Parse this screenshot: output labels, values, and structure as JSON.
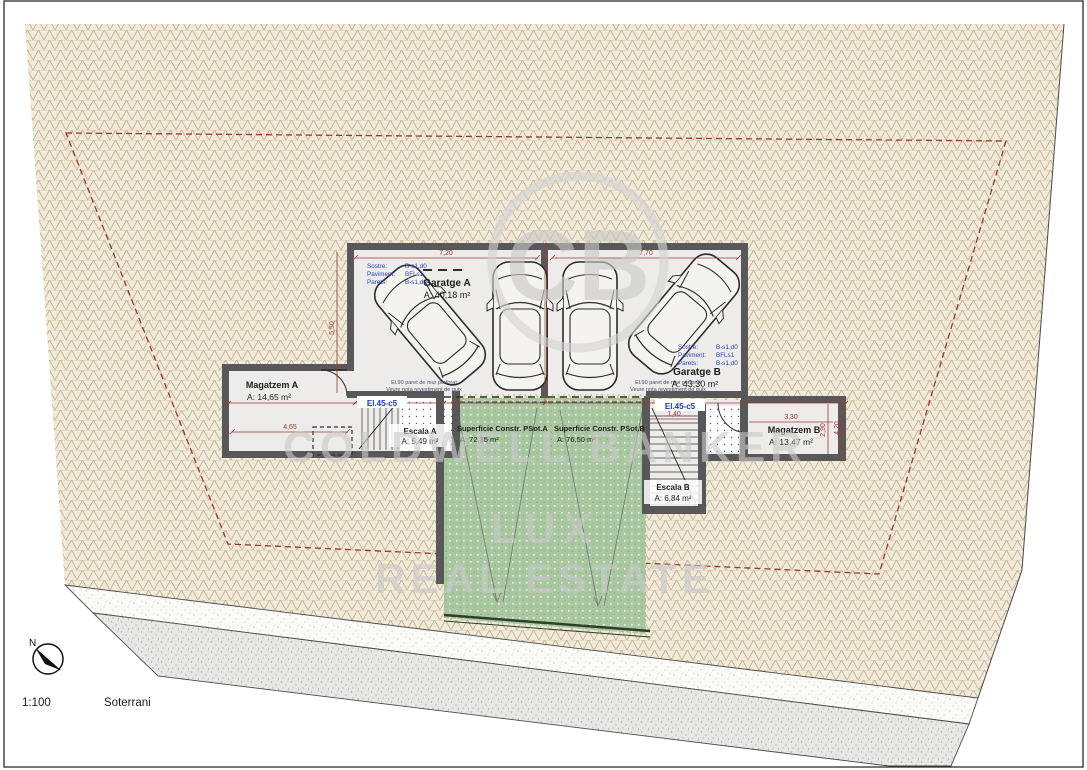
{
  "watermark": {
    "monogram": "CB",
    "brand_line1": "COLDWELL BANKER",
    "brand_line2": "LUX",
    "brand_line3": "REAL ESTATE"
  },
  "rooms": {
    "garatge_a": {
      "name": "Garatge A",
      "area": "A: 40,18 m²"
    },
    "garatge_b": {
      "name": "Garatge B",
      "area": "A: 43,30 m²"
    },
    "magatzem_a": {
      "name": "Magatzem A",
      "area": "A: 14,65 m²"
    },
    "magatzem_b": {
      "name": "Magatzem B",
      "area": "A: 13,47 m²"
    },
    "escala_a": {
      "name": "Escala A",
      "area": "A: 5,49 m²"
    },
    "escala_b": {
      "name": "Escala B",
      "area": "A: 6,84 m²"
    },
    "psot_a": {
      "name": "Superficie Constr. PSot.A",
      "area": "A: 72,35 m²"
    },
    "psot_b": {
      "name": "Superficie Constr. PSot.B",
      "area": "A: 76,50 m²"
    }
  },
  "finishes": {
    "garatge_a": {
      "sostre_label": "Sostre:",
      "sostre_value": "B-s1,d0",
      "paviment_label": "Paviment:",
      "paviment_value": "BFLs1",
      "parets_label": "Parets:",
      "parets_value": "B-s1,d0"
    },
    "garatge_b": {
      "sostre_label": "Sostre:",
      "sostre_value": "B-s1,d0",
      "paviment_label": "Paviment:",
      "paviment_value": "BFLs1",
      "parets_label": "Parets:",
      "parets_value": "B-s1,d0"
    }
  },
  "annotations": {
    "lintel_a": "El.45-c5",
    "lintel_b": "El.45-c5",
    "wall_note_line1": "El.90 paret de mur perforat",
    "wall_note_line2": "Veure nota revestiment de guix"
  },
  "dimensions": {
    "garatge_a_width": "7,20",
    "garatge_b_width": "7,70",
    "garatge_a_depth": "5,50",
    "magatzem_a_width": "4,65",
    "magatzem_b_width": "3,30",
    "escala_b_width": "1,40",
    "magatzem_b_depth_1": "2,90",
    "magatzem_b_depth_2": "4,20"
  },
  "footer": {
    "north": "N",
    "scale": "1:100",
    "plan_name": "Soterrani"
  },
  "colors": {
    "wall": "#58585a",
    "terrain_line": "#c2b193",
    "ramp_green": "#a9c7a0",
    "boundary_red": "#9a382b",
    "dimension_red": "#a03a2f",
    "annotation_blue": "#2a43c0"
  }
}
